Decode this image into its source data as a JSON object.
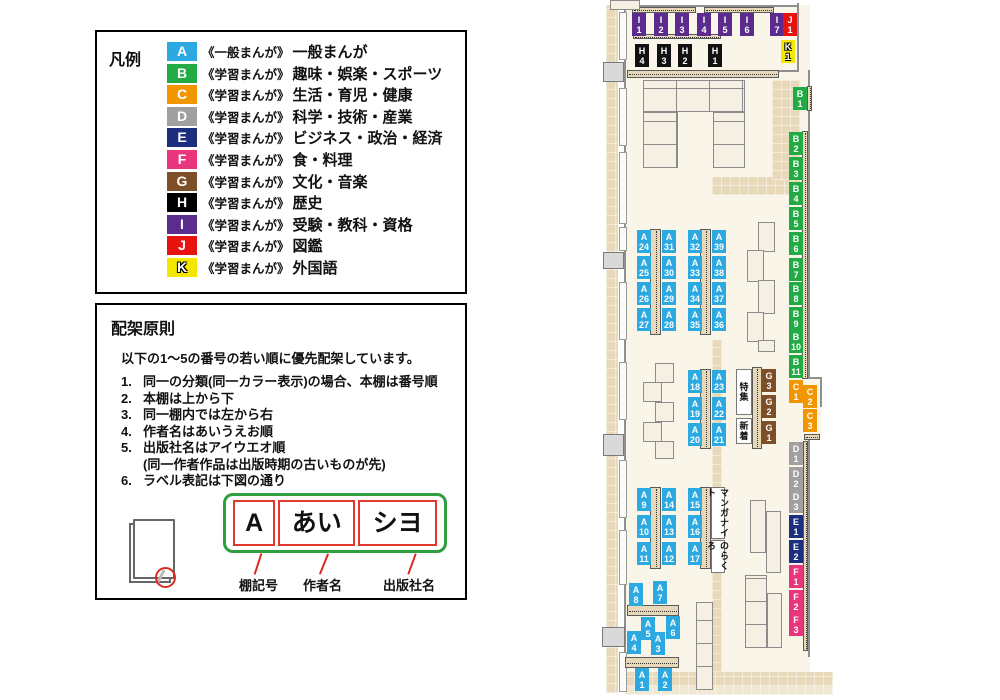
{
  "legend": {
    "title": "凡例",
    "items": [
      {
        "code": "A",
        "color": "#2ba9e0",
        "series": "《一般まんが》",
        "label": "一般まんが"
      },
      {
        "code": "B",
        "color": "#22ab44",
        "series": "《学習まんが》",
        "label": "趣味・娯楽・スポーツ"
      },
      {
        "code": "C",
        "color": "#f29600",
        "series": "《学習まんが》",
        "label": "生活・育児・健康"
      },
      {
        "code": "D",
        "color": "#a0a0a0",
        "series": "《学習まんが》",
        "label": "科学・技術・産業"
      },
      {
        "code": "E",
        "color": "#1e2e7e",
        "series": "《学習まんが》",
        "label": "ビジネス・政治・経済"
      },
      {
        "code": "F",
        "color": "#e8357e",
        "series": "《学習まんが》",
        "label": "食・料理"
      },
      {
        "code": "G",
        "color": "#7d4f28",
        "series": "《学習まんが》",
        "label": "文化・音楽"
      },
      {
        "code": "H",
        "color": "#000000",
        "series": "《学習まんが》",
        "label": "歴史"
      },
      {
        "code": "I",
        "color": "#5b2c8d",
        "series": "《学習まんが》",
        "label": "受験・教科・資格"
      },
      {
        "code": "J",
        "color": "#e8120e",
        "series": "《学習まんが》",
        "label": "図鑑"
      },
      {
        "code": "K",
        "color": "#f4e800",
        "outline": true,
        "series": "《学習まんが》",
        "label": "外国語"
      }
    ]
  },
  "principles": {
    "title": "配架原則",
    "intro": "以下の1〜5の番号の若い順に優先配架しています。",
    "rules": [
      {
        "num": "1.",
        "lines": [
          "同一の分類(同一カラー表示)の場合、本棚は番号順"
        ]
      },
      {
        "num": "2.",
        "lines": [
          "本棚は上から下"
        ]
      },
      {
        "num": "3.",
        "lines": [
          "同一棚内では左から右"
        ]
      },
      {
        "num": "4.",
        "lines": [
          "作者名はあいうえお順"
        ]
      },
      {
        "num": "5.",
        "lines": [
          "出版社名はアイウエオ順",
          "(同一作者作品は出版時期の古いものが先)"
        ]
      },
      {
        "num": "6.",
        "lines": [
          "ラベル表記は下図の通り"
        ]
      }
    ],
    "label_diagram": {
      "boxes": [
        {
          "text": "A",
          "caption": "棚記号"
        },
        {
          "text": "あい",
          "caption": "作者名"
        },
        {
          "text": "シヨ",
          "caption": "出版社名"
        }
      ]
    }
  },
  "map": {
    "category_colors": {
      "A": "#2ba9e0",
      "B": "#22ab44",
      "C": "#f29600",
      "D": "#a0a0a0",
      "E": "#1e2e7e",
      "F": "#e8357e",
      "G": "#7d4f28",
      "H": "#111111",
      "I": "#5b2c8d",
      "J": "#e8120e",
      "K": "#f4e800"
    },
    "shelf_labels": [
      {
        "id": "I1",
        "x": 32,
        "y": 13
      },
      {
        "id": "I2",
        "x": 54,
        "y": 13
      },
      {
        "id": "I3",
        "x": 75,
        "y": 13
      },
      {
        "id": "I4",
        "x": 97,
        "y": 13
      },
      {
        "id": "I5",
        "x": 118,
        "y": 13
      },
      {
        "id": "I6",
        "x": 140,
        "y": 13
      },
      {
        "id": "I7",
        "x": 170,
        "y": 13
      },
      {
        "id": "J1",
        "x": 183,
        "y": 13
      },
      {
        "id": "K1",
        "x": 181,
        "y": 40
      },
      {
        "id": "H4",
        "x": 35,
        "y": 44
      },
      {
        "id": "H3",
        "x": 57,
        "y": 44
      },
      {
        "id": "H2",
        "x": 78,
        "y": 44
      },
      {
        "id": "H1",
        "x": 108,
        "y": 44
      },
      {
        "id": "B1",
        "x": 193,
        "y": 87
      },
      {
        "id": "B2",
        "x": 189,
        "y": 132
      },
      {
        "id": "B3",
        "x": 189,
        "y": 157
      },
      {
        "id": "B4",
        "x": 189,
        "y": 182
      },
      {
        "id": "B5",
        "x": 189,
        "y": 207
      },
      {
        "id": "B6",
        "x": 189,
        "y": 232
      },
      {
        "id": "B7",
        "x": 189,
        "y": 258
      },
      {
        "id": "B8",
        "x": 189,
        "y": 282
      },
      {
        "id": "B9",
        "x": 189,
        "y": 307
      },
      {
        "id": "B10",
        "x": 189,
        "y": 330
      },
      {
        "id": "B11",
        "x": 189,
        "y": 355
      },
      {
        "id": "C1",
        "x": 189,
        "y": 380
      },
      {
        "id": "C2",
        "x": 203,
        "y": 385
      },
      {
        "id": "C3",
        "x": 203,
        "y": 409
      },
      {
        "id": "D1",
        "x": 189,
        "y": 442
      },
      {
        "id": "D2",
        "x": 189,
        "y": 467
      },
      {
        "id": "D3",
        "x": 189,
        "y": 490
      },
      {
        "id": "E1",
        "x": 189,
        "y": 515
      },
      {
        "id": "E2",
        "x": 189,
        "y": 540
      },
      {
        "id": "F1",
        "x": 189,
        "y": 565
      },
      {
        "id": "F2",
        "x": 189,
        "y": 590
      },
      {
        "id": "F3",
        "x": 189,
        "y": 613
      },
      {
        "id": "G3",
        "x": 162,
        "y": 369
      },
      {
        "id": "G2",
        "x": 162,
        "y": 395
      },
      {
        "id": "G1",
        "x": 162,
        "y": 421
      },
      {
        "id": "A24",
        "x": 37,
        "y": 230
      },
      {
        "id": "A31",
        "x": 62,
        "y": 230
      },
      {
        "id": "A32",
        "x": 88,
        "y": 230
      },
      {
        "id": "A39",
        "x": 112,
        "y": 230
      },
      {
        "id": "A25",
        "x": 37,
        "y": 256
      },
      {
        "id": "A30",
        "x": 62,
        "y": 256
      },
      {
        "id": "A33",
        "x": 88,
        "y": 256
      },
      {
        "id": "A38",
        "x": 112,
        "y": 256
      },
      {
        "id": "A26",
        "x": 37,
        "y": 282
      },
      {
        "id": "A29",
        "x": 62,
        "y": 282
      },
      {
        "id": "A34",
        "x": 88,
        "y": 282
      },
      {
        "id": "A37",
        "x": 112,
        "y": 282
      },
      {
        "id": "A27",
        "x": 37,
        "y": 308
      },
      {
        "id": "A28",
        "x": 62,
        "y": 308
      },
      {
        "id": "A35",
        "x": 88,
        "y": 308
      },
      {
        "id": "A36",
        "x": 112,
        "y": 308
      },
      {
        "id": "A18",
        "x": 88,
        "y": 370
      },
      {
        "id": "A23",
        "x": 112,
        "y": 370
      },
      {
        "id": "A19",
        "x": 88,
        "y": 397
      },
      {
        "id": "A22",
        "x": 112,
        "y": 397
      },
      {
        "id": "A20",
        "x": 88,
        "y": 423
      },
      {
        "id": "A21",
        "x": 112,
        "y": 423
      },
      {
        "id": "A9",
        "x": 37,
        "y": 488
      },
      {
        "id": "A14",
        "x": 62,
        "y": 488
      },
      {
        "id": "A15",
        "x": 88,
        "y": 488
      },
      {
        "id": "A10",
        "x": 37,
        "y": 515
      },
      {
        "id": "A13",
        "x": 62,
        "y": 515
      },
      {
        "id": "A16",
        "x": 88,
        "y": 515
      },
      {
        "id": "A11",
        "x": 37,
        "y": 542
      },
      {
        "id": "A12",
        "x": 62,
        "y": 542
      },
      {
        "id": "A17",
        "x": 88,
        "y": 542
      },
      {
        "id": "A8",
        "x": 29,
        "y": 583
      },
      {
        "id": "A7",
        "x": 53,
        "y": 581
      },
      {
        "id": "A5",
        "x": 41,
        "y": 617
      },
      {
        "id": "A6",
        "x": 66,
        "y": 616
      },
      {
        "id": "A4",
        "x": 27,
        "y": 631
      },
      {
        "id": "A3",
        "x": 51,
        "y": 632
      },
      {
        "id": "A1",
        "x": 35,
        "y": 668
      },
      {
        "id": "A2",
        "x": 58,
        "y": 668
      }
    ],
    "area_labels": [
      {
        "text": "特集",
        "x": 136,
        "y": 369,
        "w": 16,
        "h": 46
      },
      {
        "text": "新着",
        "x": 136,
        "y": 418,
        "w": 16,
        "h": 26
      },
      {
        "text": "マンガナイト",
        "x": 111,
        "y": 487,
        "w": 14,
        "h": 52
      },
      {
        "text": "のらくろ",
        "x": 111,
        "y": 540,
        "w": 14,
        "h": 33
      }
    ]
  }
}
